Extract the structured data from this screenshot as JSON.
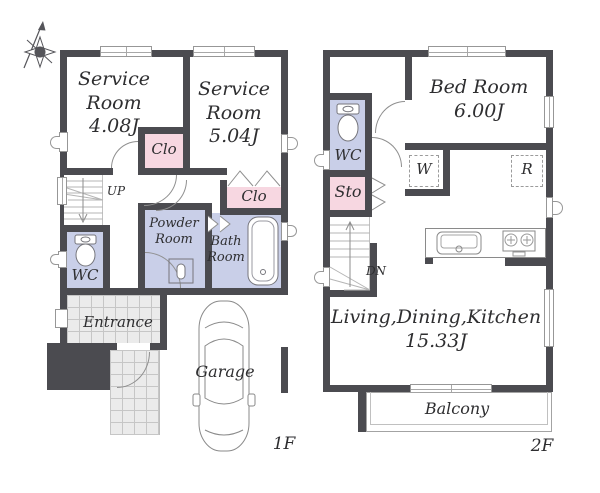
{
  "colors": {
    "wall": "#4b4b50",
    "closet_pink": "#f7d7e1",
    "wet_room_lavender": "#c9cfe8",
    "tile_gray": "#ebebeb",
    "text": "#2e2e30"
  },
  "floor1": {
    "floor_label": "1F",
    "rooms": {
      "service_room_1": "Service\nRoom\n4.08J",
      "service_room_2": "Service\nRoom\n5.04J",
      "closet_1": "Clo",
      "closet_2": "Clo",
      "powder_room": "Powder\nRoom",
      "bath_room": "Bath\nRoom",
      "wc": "WC",
      "entrance": "Entrance",
      "garage": "Garage"
    },
    "stairs": {
      "direction_label": "UP"
    },
    "icons": [
      "compass-rose-icon",
      "toilet-icon",
      "washbasin-icon",
      "bathtub-icon",
      "car-icon"
    ]
  },
  "floor2": {
    "floor_label": "2F",
    "rooms": {
      "bed_room": "Bed Room\n6.00J",
      "wc": "WC",
      "storage": "Sto",
      "washer_space": "W",
      "refrigerator_space": "R",
      "ldk": "Living,Dining,Kitchen\n15.33J",
      "balcony": "Balcony"
    },
    "stairs": {
      "direction_label": "DN"
    },
    "icons": [
      "toilet-icon",
      "kitchen-sink-icon",
      "stove-icon"
    ]
  }
}
